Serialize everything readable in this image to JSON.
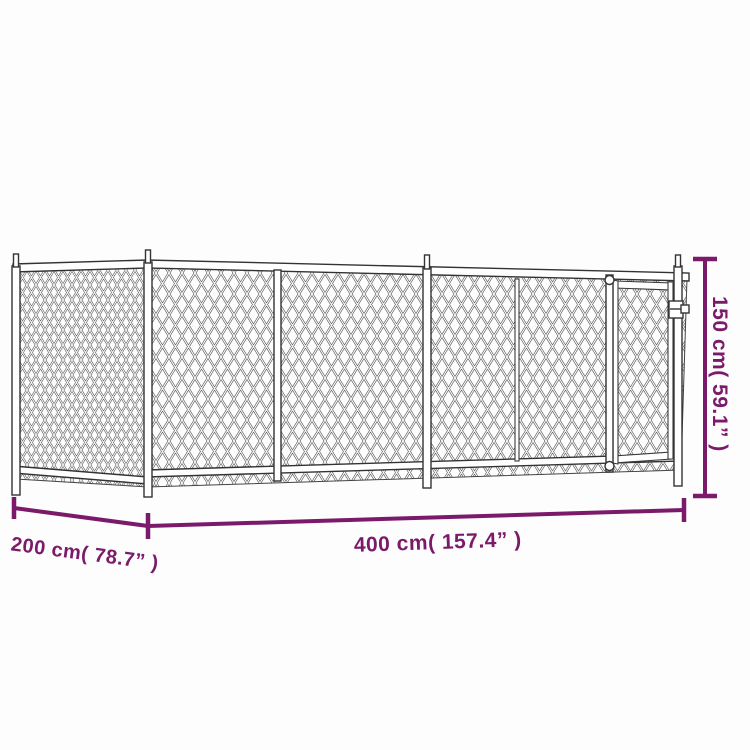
{
  "illustration": "chain-link-dog-kennel-with-gate",
  "colors": {
    "dimension": "#7b1a6b",
    "outline": "#333333",
    "background": "#fdfdfd"
  },
  "annotations": {
    "height": "150 cm( 59.1” )",
    "length": "400 cm( 157.4” )",
    "depth": "200 cm( 78.7” )"
  }
}
